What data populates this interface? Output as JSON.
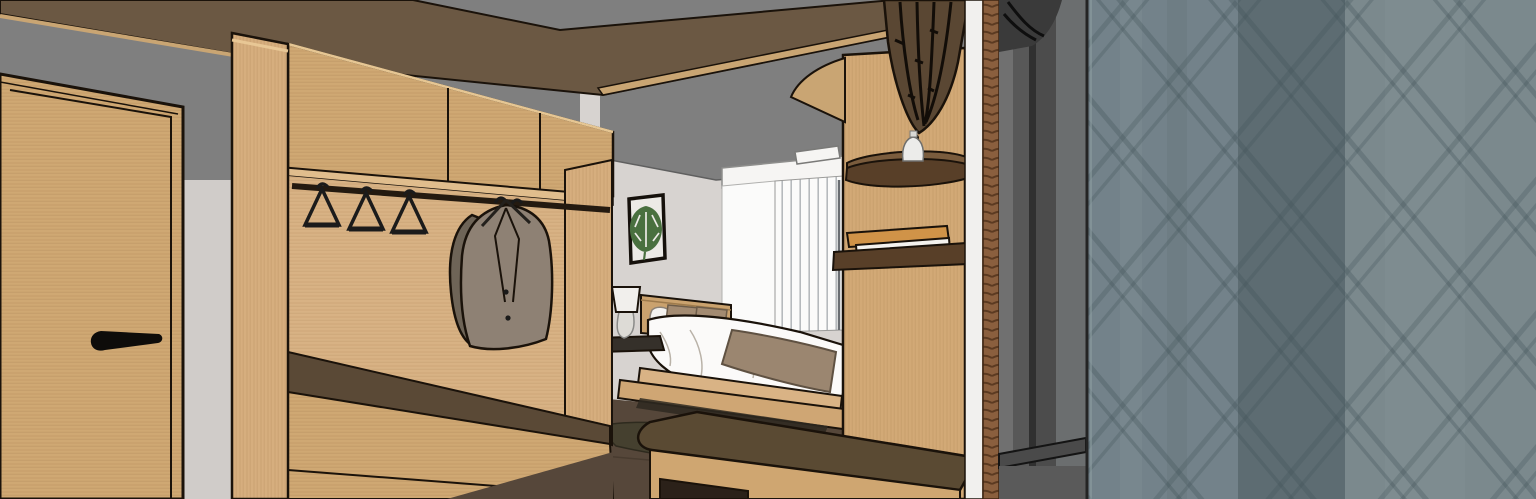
{
  "meta": {
    "title": "3D interior render: hotel room entry with oak wardrobe, bed alcove and glazed partition",
    "style": "sketchup-line-render",
    "canvas": {
      "width": 1536,
      "height": 499
    }
  },
  "palette": {
    "ceilingGray": "#7f7f7f",
    "wallGray": "#d7d3d0",
    "wallShade": "#c8c4c1",
    "soffitBrown": "#6b5843",
    "fasciaWood": "#c9a573",
    "woodCabinet": "#cfa873",
    "woodPillar": "#d6ae7e",
    "woodNicheBack": "#d8b284",
    "woodPlatform": "#d9b385",
    "woodPlatform2": "#cfa674",
    "darkShelfBrown": "#5a4936",
    "floorBrown": "#56473a",
    "rugBrown": "#45402f",
    "railBlack": "#241a10",
    "hangerBlack": "#1b1b1b",
    "coatTaupe": "#8e8174",
    "coatShadow": "#6e6457",
    "artMat": "#eceae6",
    "frameBlack": "#15100b",
    "leafGreen": "#49703f",
    "valanceWhite": "#f6f5f3",
    "blindWhite": "#fbfbfa",
    "blindStripe": "#b6babd",
    "duvetWhite": "#fbfaf9",
    "pillowTan": "#a38b72",
    "throwTaupe": "#9b8670",
    "headboardWood": "#caa26e",
    "nightstandDark": "#35302a",
    "lampShade": "#f1efec",
    "lampGlass": "#dddbd6",
    "benchOlive": "#a89a4f",
    "consoleTop": "#5a4a33",
    "consoleWood": "#cfa671",
    "nicheDark": "#2b2119",
    "columnWood": "#d2a976",
    "shelfTopWood": "#7a5c3d",
    "shelfFrontWood": "#583f28",
    "bookOrange": "#d09348",
    "bookWhite": "#f4f2ee",
    "vaseWhite": "#ececea",
    "coneBrown": "#5a4733",
    "ribBlack": "#120d08",
    "ropeBrown": "#8a5f3e",
    "edgeWhite": "#f1f0ee",
    "frameGrayA": "#707070",
    "frameGrayB": "#585858",
    "frameGrayC": "#4c4c4c",
    "frameGrayDark": "#303030",
    "blobGray": "#3a3a3a",
    "sillGray": "#4a4a4a",
    "sillLower": "#5a5a5a",
    "glassMid": "#73828a",
    "glassDark": "#5d6c72",
    "glassLight": "#7b898d",
    "hatchLine": "#3f5156",
    "underBedShadow": "#2e2921",
    "outline": "#1a120a"
  },
  "scene": {
    "objects": [
      {
        "name": "entry-door",
        "description": "light oak flush door with black edge outlines and inset panel line",
        "color": "woodCabinet"
      },
      {
        "name": "door-handle",
        "description": "black lever handle pointing right",
        "color": "hangerBlack"
      },
      {
        "name": "entry-wall",
        "description": "light gray wall strip between door and wardrobe",
        "color": "wallGray"
      },
      {
        "name": "ceiling",
        "description": "flat gray ceiling",
        "color": "ceilingGray"
      },
      {
        "name": "entry-canopy",
        "description": "dark walnut soffit / header beam with light oak fascia strip",
        "color": "soffitBrown"
      },
      {
        "name": "wardrobe-pillar",
        "description": "vertical oak end pillar of wardrobe",
        "color": "woodPillar"
      },
      {
        "name": "wardrobe-upper-cabinets",
        "description": "three-door oak upper cabinet row",
        "color": "woodCabinet"
      },
      {
        "name": "hanger-rail",
        "description": "dark metal hanging rail",
        "color": "railBlack"
      },
      {
        "name": "empty-hangers",
        "description": "three empty black wire hangers",
        "count": 3,
        "color": "hangerBlack"
      },
      {
        "name": "hanging-coats",
        "description": "two taupe jackets on hangers",
        "count": 2,
        "color": "coatTaupe"
      },
      {
        "name": "wardrobe-bench",
        "description": "bench seat with dark recessed shelf and oak drawer front",
        "color": "darkShelfBrown"
      },
      {
        "name": "bedroom-walls",
        "description": "light gray alcove walls",
        "color": "wallGray"
      },
      {
        "name": "wall-art-monstera",
        "description": "black framed print of a green monstera leaf",
        "color": "leafGreen"
      },
      {
        "name": "window-blinds",
        "description": "white vertical blinds with valance behind bed",
        "color": "blindWhite"
      },
      {
        "name": "ceiling-light",
        "description": "recessed white ceiling fixture",
        "color": "valanceWhite"
      },
      {
        "name": "bed",
        "description": "double bed, white duvet, tan pillows, taupe throw, oak headboard and two-tier platform",
        "color": "duvetWhite"
      },
      {
        "name": "nightstand",
        "description": "floating nightstand with dark top",
        "color": "nightstandDark"
      },
      {
        "name": "table-lamp",
        "description": "white shade lamp with glass body",
        "color": "lampShade"
      },
      {
        "name": "foot-bench",
        "description": "olive upholstered bench at bed foot",
        "color": "benchOlive"
      },
      {
        "name": "area-rug",
        "description": "dark brown rug on wood floor",
        "color": "rugBrown"
      },
      {
        "name": "wood-floor",
        "description": "dark stained plank floor",
        "color": "floorBrown"
      },
      {
        "name": "console-table",
        "description": "low console with dark walnut top, oak base and open niche",
        "color": "consoleTop"
      },
      {
        "name": "partition-column",
        "description": "oak partition column between bed nook and entry",
        "color": "columnWood"
      },
      {
        "name": "round-shelf",
        "description": "rounded walnut display shelf on column",
        "color": "shelfTopWood"
      },
      {
        "name": "vase",
        "description": "small white vase/lamp on round shelf",
        "color": "vaseWhite"
      },
      {
        "name": "pendant-cone",
        "description": "dark ribbed conical pendant ornament above shelf",
        "color": "coneBrown"
      },
      {
        "name": "book-shelf",
        "description": "small walnut ledge with two books",
        "color": "shelfFrontWood"
      },
      {
        "name": "books",
        "description": "orange book and white book stacked flat",
        "count": 2,
        "colors": [
          "bookOrange",
          "bookWhite"
        ]
      },
      {
        "name": "rope-trim",
        "description": "vertical brown rope detail at partition edge",
        "color": "ropeBrown"
      },
      {
        "name": "wall-edge",
        "description": "white vertical wall return strip",
        "color": "edgeWhite"
      },
      {
        "name": "partition-frame",
        "description": "dark gray glazing frame bands with sill",
        "color": "frameGrayB"
      },
      {
        "name": "glazed-partition",
        "description": "blue-gray glass / screen with diagonal diamond lattice pattern in three vertical bands",
        "colors": [
          "glassMid",
          "glassDark",
          "glassLight"
        ]
      }
    ]
  }
}
